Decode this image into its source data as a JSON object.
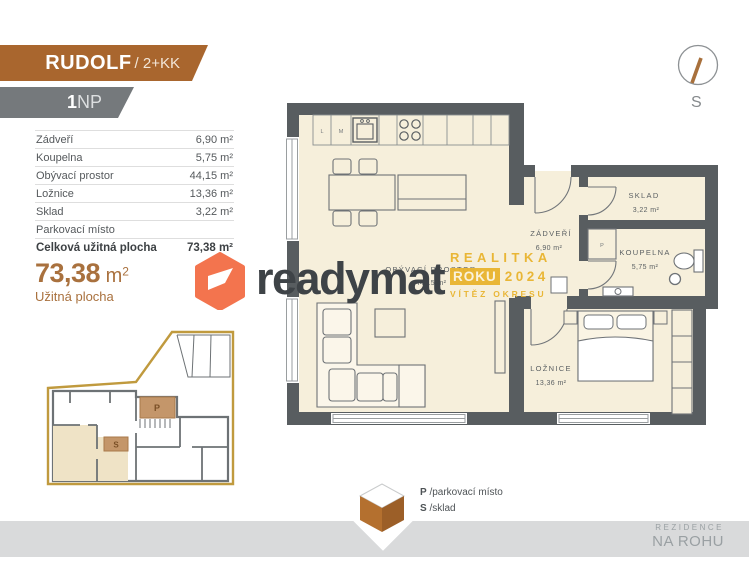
{
  "header": {
    "title": "RUDOLF",
    "title_suffix": "/ 2+KK",
    "floor_bold": "1",
    "floor_rest": "NP"
  },
  "compass": {
    "south": "S"
  },
  "room_table": {
    "rows": [
      {
        "label": "Zádveří",
        "value": "6,90 m²"
      },
      {
        "label": "Koupelna",
        "value": "5,75 m²"
      },
      {
        "label": "Obývací prostor",
        "value": "44,15 m²"
      },
      {
        "label": "Ložnice",
        "value": "13,36 m²"
      },
      {
        "label": "Sklad",
        "value": "3,22 m²"
      },
      {
        "label": "Parkovací místo",
        "value": ""
      },
      {
        "label": "Celková užitná plocha",
        "value": "73,38 m²"
      }
    ]
  },
  "total_area": {
    "value": "73,38",
    "unit": " m",
    "exp": "2",
    "caption": "Užitná plocha"
  },
  "brand": {
    "name": "readymat"
  },
  "award": {
    "line1": "REALITKA",
    "word": "ROKU",
    "year": "2024",
    "line3": "VÍTĚZ OKRESU"
  },
  "floorplan": {
    "living": {
      "name": "OBÝVACÍ PROSTOR",
      "area": "44,15 m²"
    },
    "entry": {
      "name": "ZÁDVEŘÍ",
      "area": "6,90 m²"
    },
    "storage": {
      "name": "SKLAD",
      "area": "3,22 m²"
    },
    "bathroom": {
      "name": "KOUPELNA",
      "area": "5,75 m²"
    },
    "bedroom": {
      "name": "LOŽNICE",
      "area": "13,36 m²"
    },
    "kitchen": {
      "fridge": "L",
      "dishwasher": "M"
    },
    "washer_label": "P"
  },
  "site_plan": {
    "parking": "P",
    "storage": "S"
  },
  "legend": {
    "items": [
      {
        "key": "P",
        "label": "/parkovací místo"
      },
      {
        "key": "S",
        "label": "/sklad"
      }
    ]
  },
  "project": {
    "line1": "REZIDENCE",
    "line2": "NA ROHU"
  },
  "colors": {
    "accent": "#a9662e",
    "banner_gray": "#75797c",
    "area_text": "#a9713e",
    "brand_coral": "#f3744e",
    "award_gold": "#e9b42e",
    "wall": "#585d60",
    "floor": "#f6efdb",
    "site_outline": "#c09a3e"
  }
}
